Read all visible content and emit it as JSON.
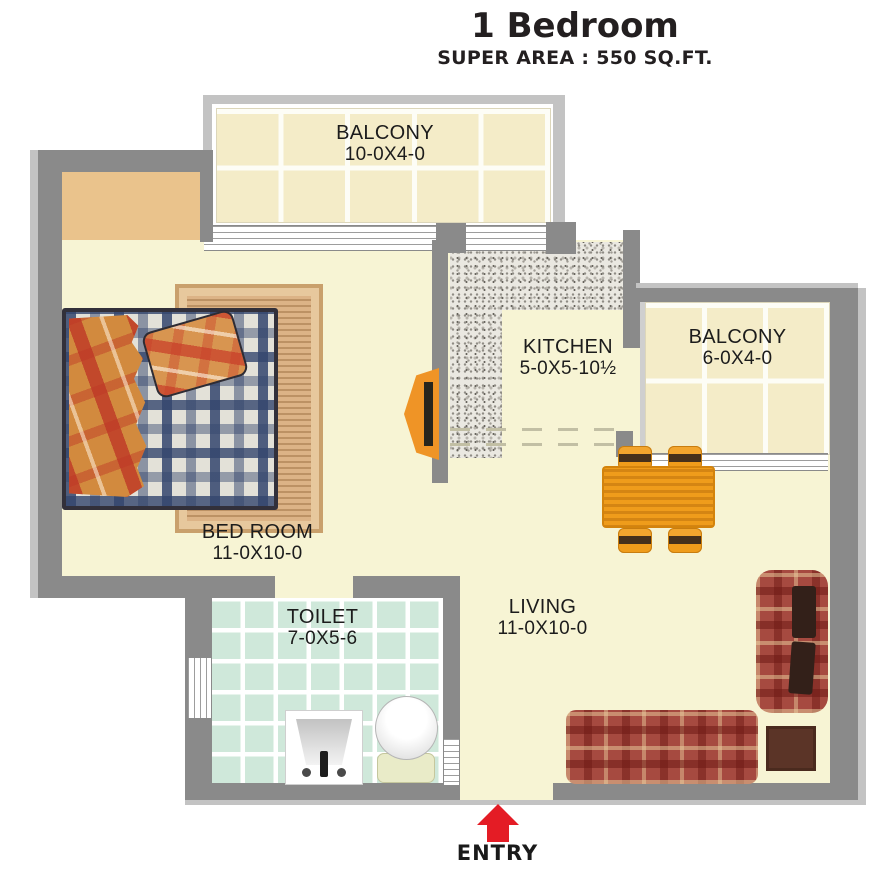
{
  "header": {
    "title": "1 Bedroom",
    "subtitle": "SUPER AREA : 550 SQ.FT."
  },
  "rooms": {
    "balcony_top": {
      "name": "BALCONY",
      "dims": "10-0X4-0"
    },
    "bedroom": {
      "name": "BED ROOM",
      "dims": "11-0X10-0"
    },
    "kitchen": {
      "name": "KITCHEN",
      "dims": "5-0X5-10½"
    },
    "balcony_right": {
      "name": "BALCONY",
      "dims": "6-0X4-0"
    },
    "toilet": {
      "name": "TOILET",
      "dims": "7-0X5-6"
    },
    "living": {
      "name": "LIVING",
      "dims": "11-0X10-0"
    }
  },
  "entry": {
    "label": "ENTRY"
  },
  "colors": {
    "wall": "#8a8a8a",
    "wall_light": "#c3c3c3",
    "floor": "#f7f4d4",
    "tile_cream": "#f4ecc8",
    "tile_mint": "#cfe8da",
    "closet_tan": "#eac38c",
    "furniture_orange": "#ef9c1b",
    "sofa_red": "#a64a40",
    "side_table_brown": "#5b3427",
    "arrow_red": "#e41c25",
    "text": "#1c1c1c"
  }
}
